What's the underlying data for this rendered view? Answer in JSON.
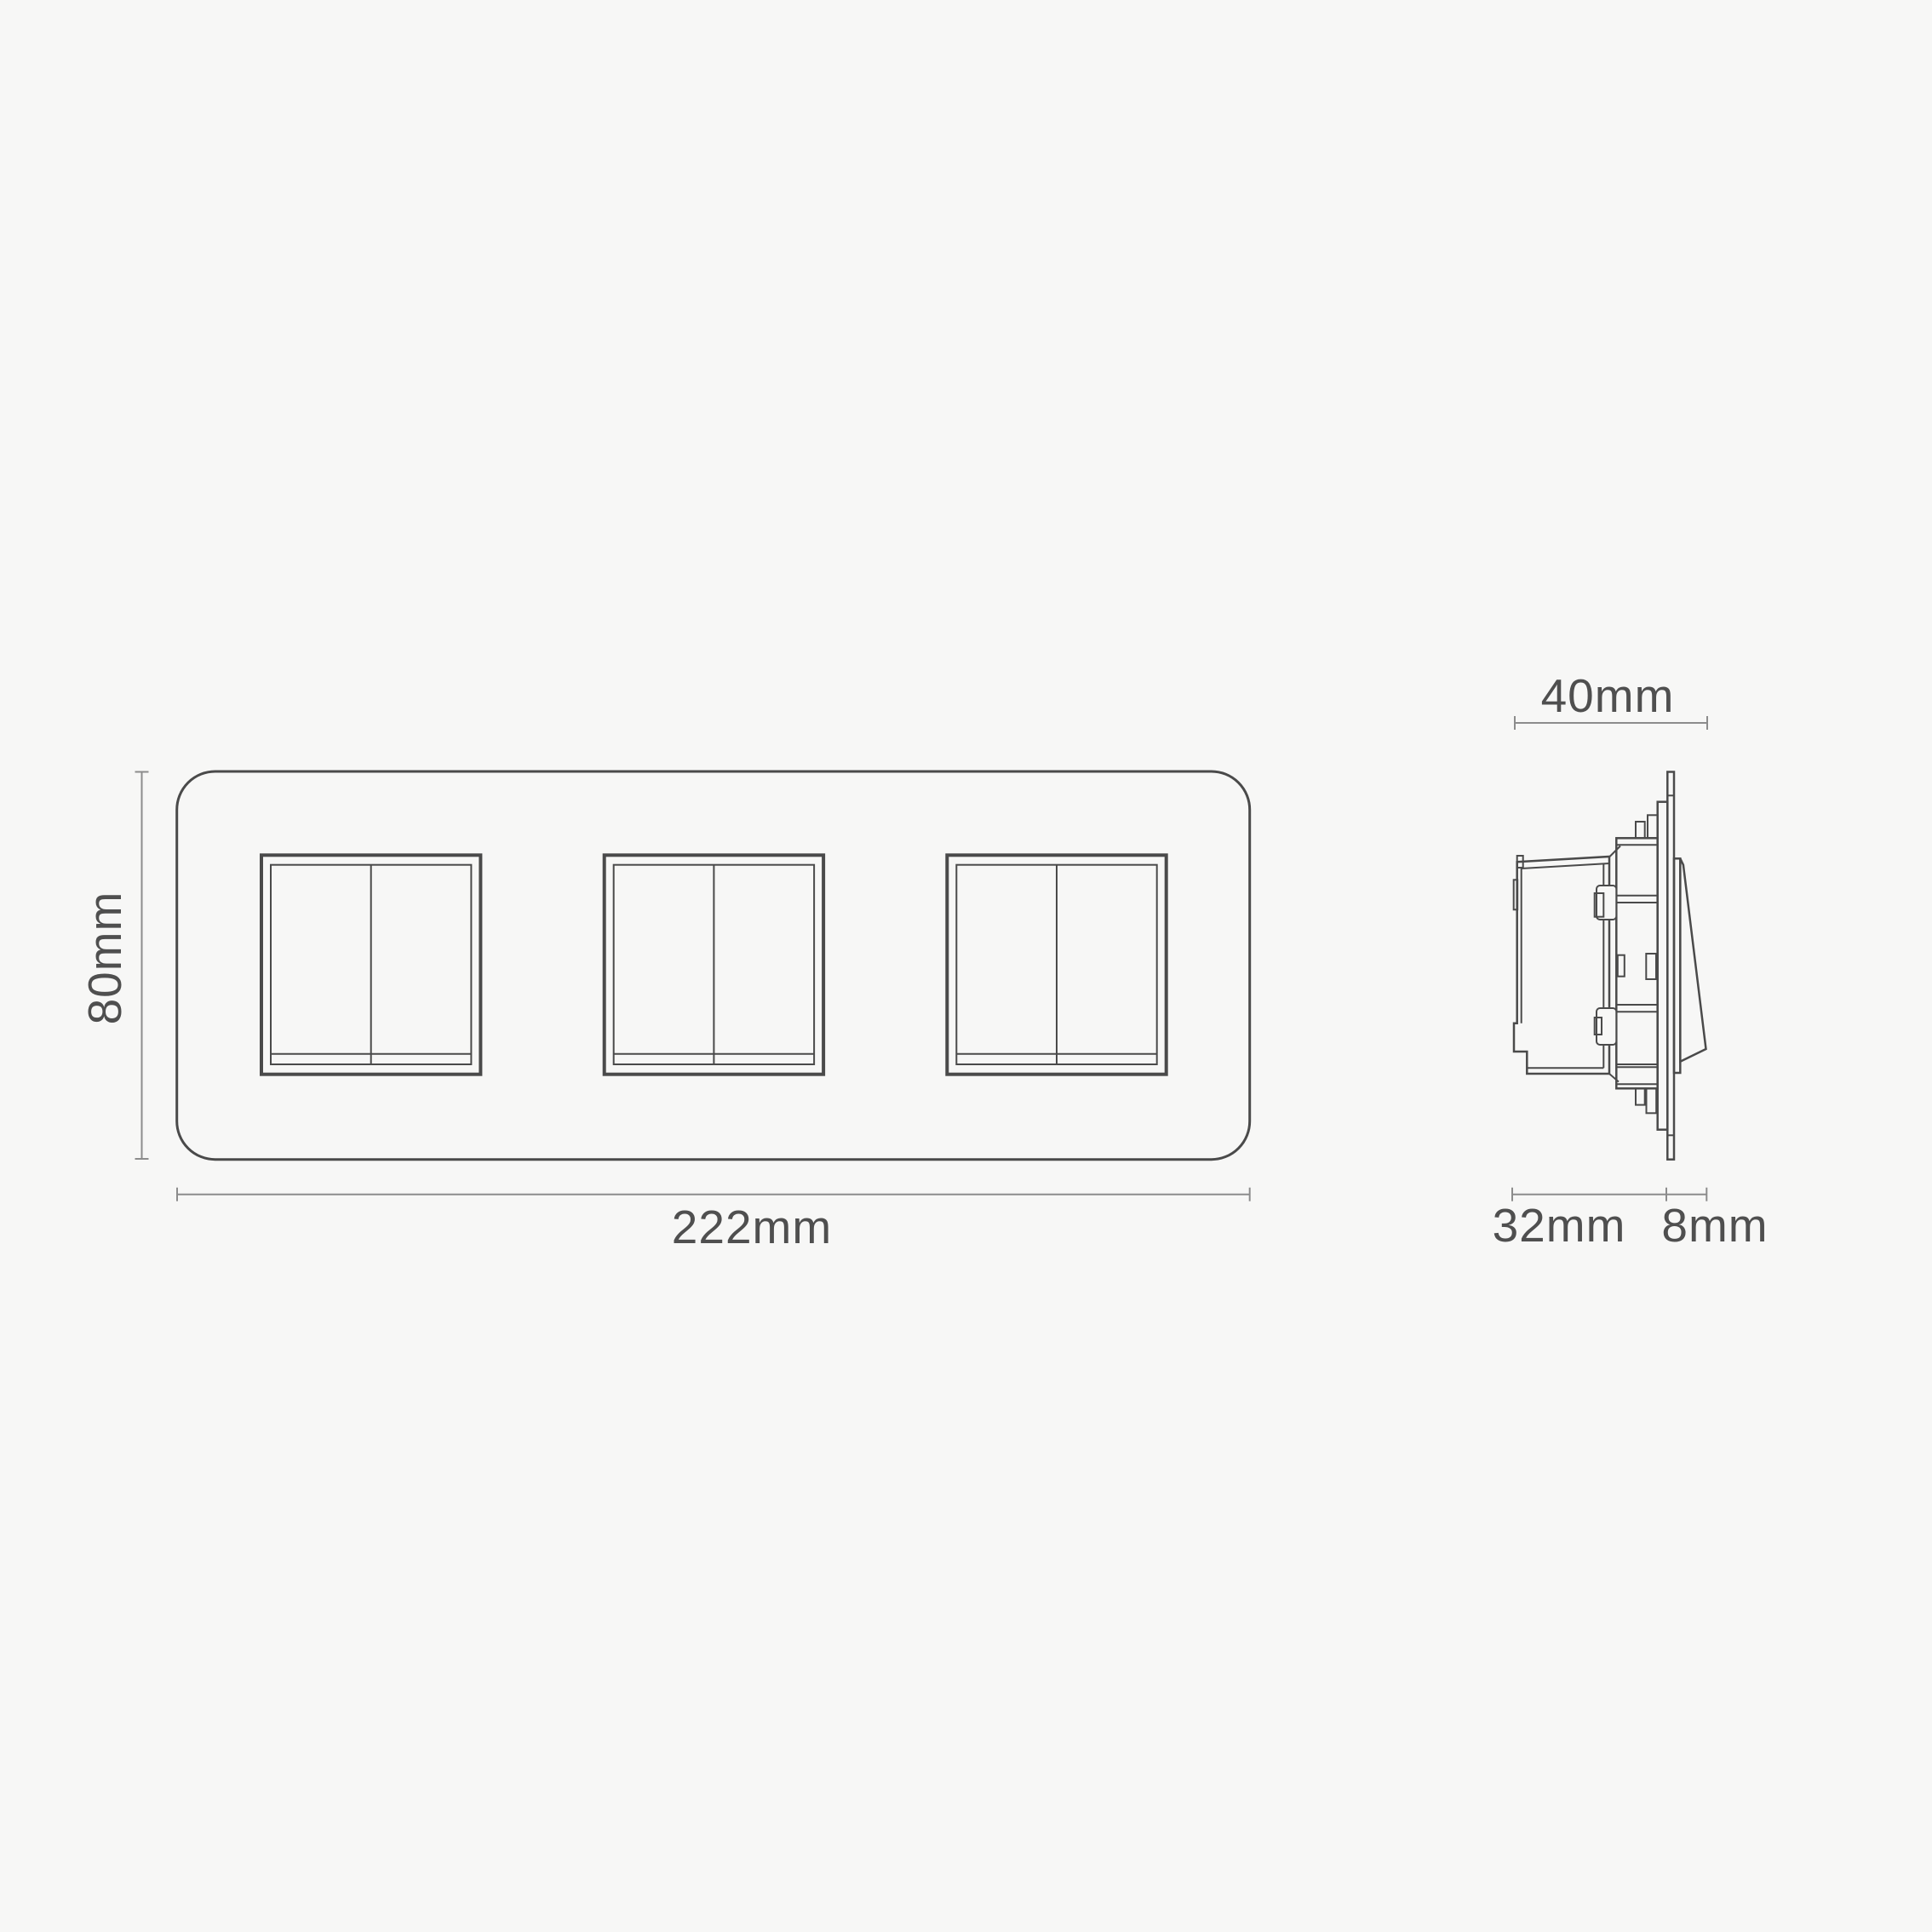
{
  "colors": {
    "background": "#f7f7f6",
    "drawing_line": "#4a4a4a",
    "dimension_line": "#8c8c8c",
    "label_text": "#4f4f4f"
  },
  "front_view": {
    "height_label": "80mm",
    "width_label": "222mm",
    "switch_count": 3
  },
  "side_view": {
    "total_depth_label": "40mm",
    "box_depth_label": "32mm",
    "protrusion_label": "8mm"
  }
}
